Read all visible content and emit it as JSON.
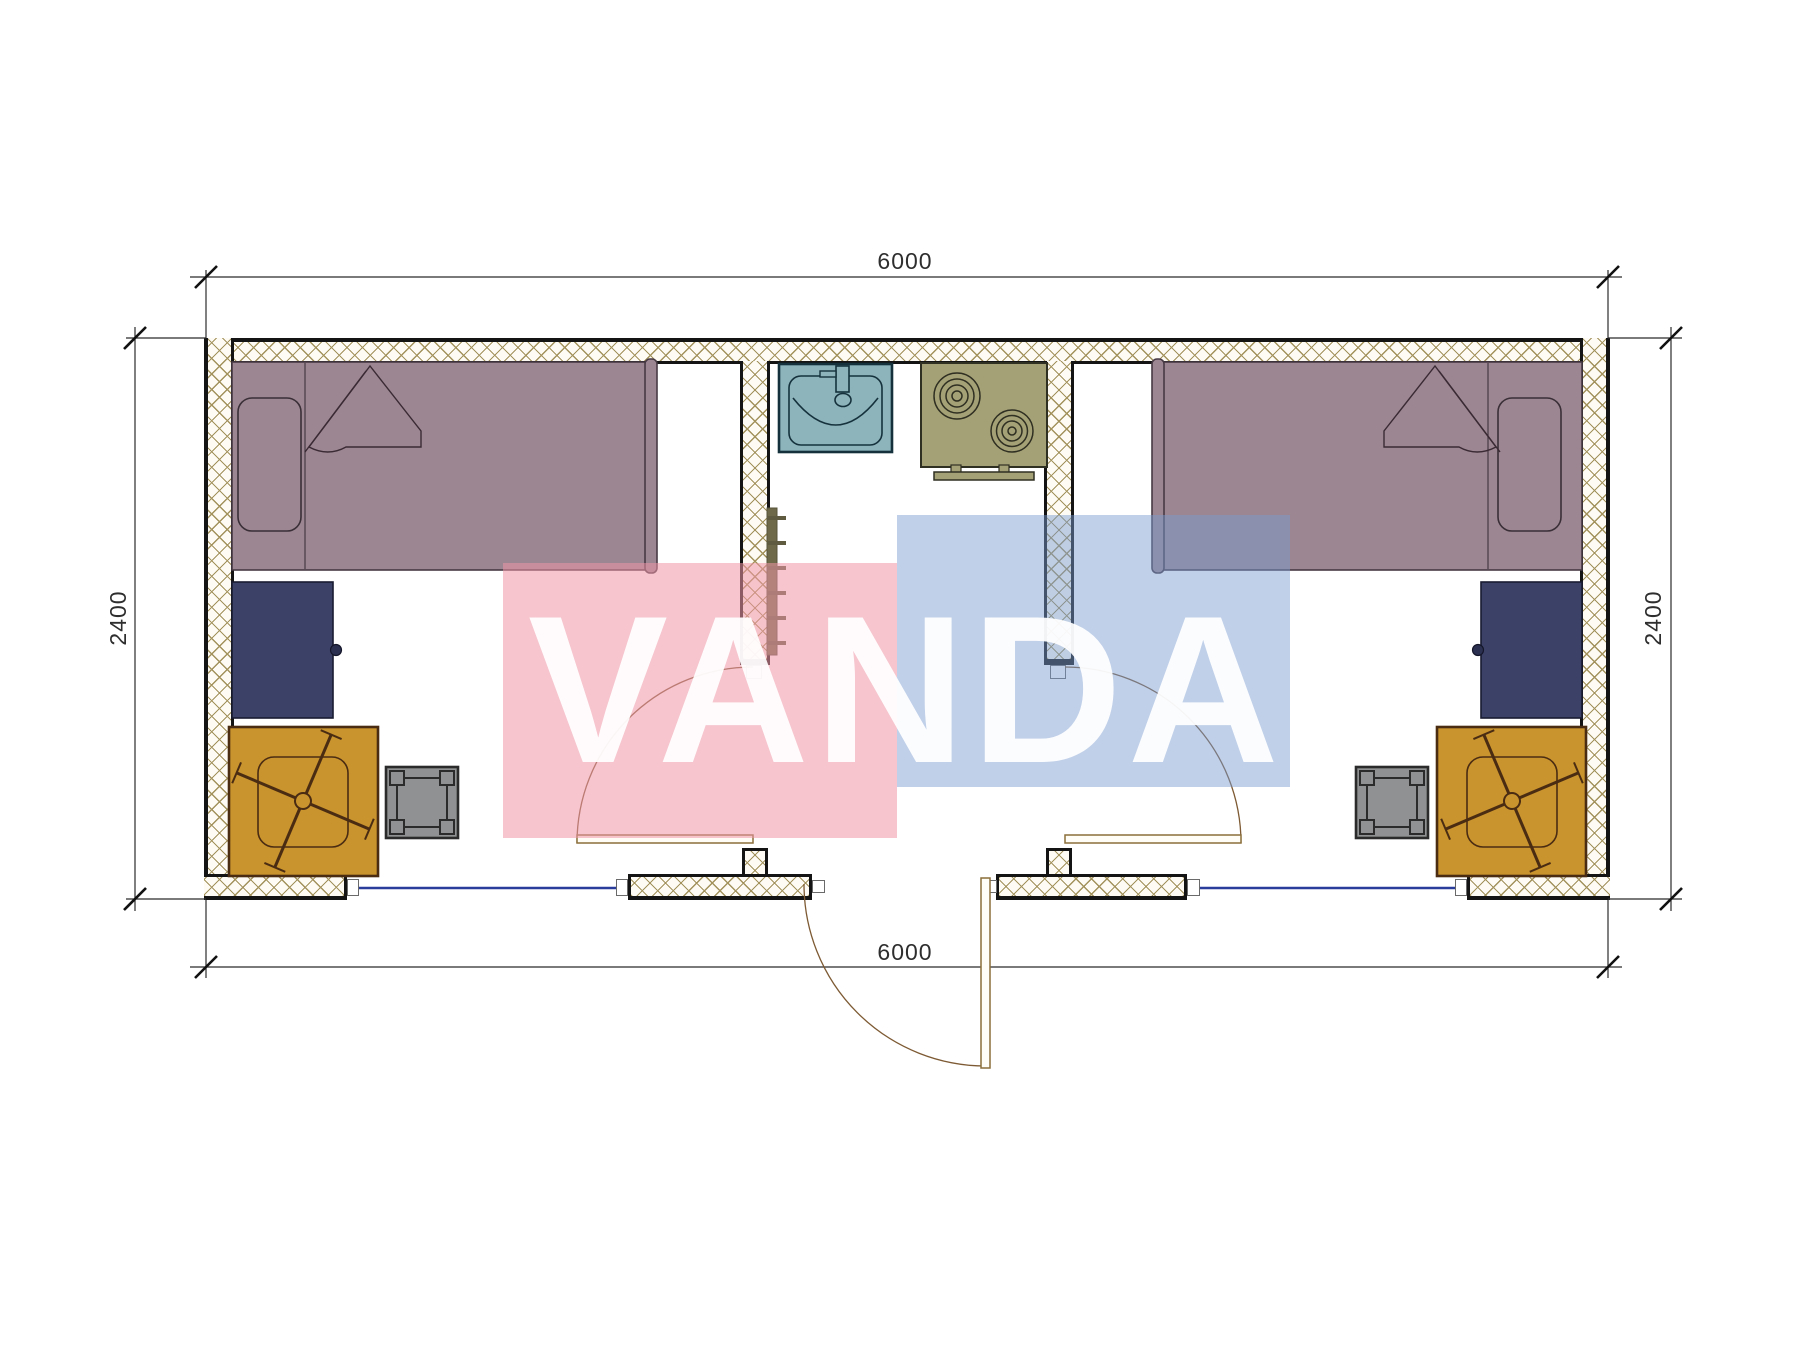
{
  "page": {
    "type": "architectural floor plan drawing",
    "background": "#ffffff",
    "units": "mm"
  },
  "dimensions": {
    "top_width": "6000",
    "bottom_width": "6000",
    "left_height": "2400",
    "right_height": "2400"
  },
  "watermark": {
    "text": "VANDA",
    "pink_color": "#ef96a6",
    "blue_color": "#7a9cd0",
    "text_color": "#ffffff"
  },
  "palette": {
    "wall_hatch": "#a3925c",
    "wall_border": "#141414",
    "bed": "#9c8692",
    "desk": "#3c4267",
    "chair": "#c9932d",
    "stool": "#8f9192",
    "sink": "#8db3bb",
    "stove": "#a5a176",
    "radiator": "#6e6948",
    "window_line": "#2b3d9b",
    "door_line": "#7d5a33"
  },
  "left_room": {
    "items": [
      "single-bed",
      "pillow",
      "blanket-fold",
      "desk",
      "office-chair",
      "stool",
      "window-opening",
      "interior-door"
    ]
  },
  "right_room": {
    "items": [
      "single-bed",
      "pillow",
      "blanket-fold",
      "desk",
      "office-chair",
      "stool",
      "window-opening",
      "interior-door"
    ]
  },
  "utility_core": {
    "items": [
      "wash-basin",
      "two-burner-stove",
      "towel-radiator",
      "entrance-door"
    ]
  }
}
